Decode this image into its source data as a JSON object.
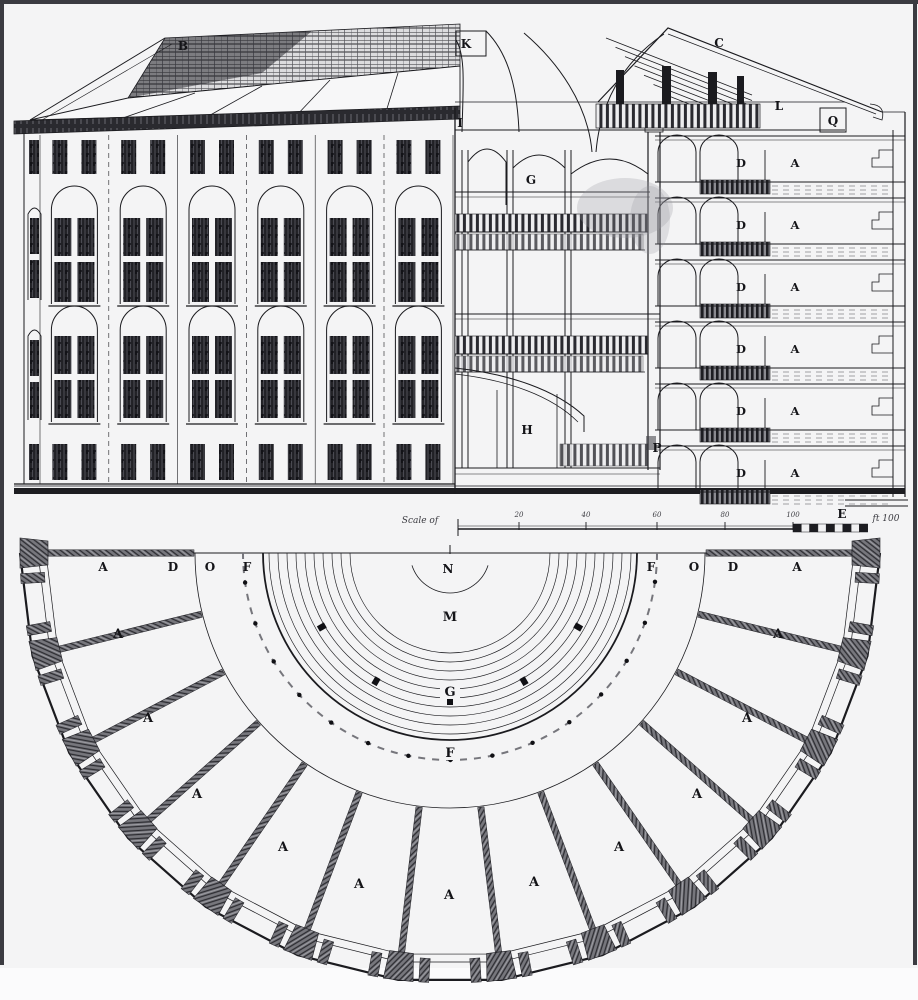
{
  "palette": {
    "paper": "#f4f4f5",
    "ink": "#1b1b1f",
    "mid_gray": "#6e6e74",
    "dark": "#1d1d21",
    "frame": "#3b3b41"
  },
  "section": {
    "labels": [
      {
        "t": "B",
        "x": 183,
        "y": 50
      },
      {
        "t": "K",
        "x": 466,
        "y": 48
      },
      {
        "t": "C",
        "x": 719,
        "y": 47
      },
      {
        "t": "I",
        "x": 460,
        "y": 127
      },
      {
        "t": "G",
        "x": 531,
        "y": 184
      },
      {
        "t": "L",
        "x": 779,
        "y": 110
      },
      {
        "t": "Q",
        "x": 833,
        "y": 125
      },
      {
        "t": "H",
        "x": 527,
        "y": 434
      },
      {
        "t": "P",
        "x": 657,
        "y": 452
      },
      {
        "t": "E",
        "x": 842,
        "y": 518
      }
    ],
    "cell_door_letter": "D",
    "cell_room_letter": "A",
    "level_tops": [
      136,
      198,
      260,
      322,
      384,
      446
    ]
  },
  "scale_bar": {
    "left_text": "Scale of",
    "tick_labels": [
      "20",
      "40",
      "60",
      "80",
      "100"
    ],
    "right_text": "ft 100"
  },
  "plan": {
    "top_row_labels": [
      {
        "t": "A",
        "x": 103,
        "y": 571
      },
      {
        "t": "D",
        "x": 173,
        "y": 571
      },
      {
        "t": "O",
        "x": 210,
        "y": 571
      },
      {
        "t": "F",
        "x": 247,
        "y": 571
      },
      {
        "t": "N",
        "x": 448,
        "y": 573
      },
      {
        "t": "F",
        "x": 651,
        "y": 571
      },
      {
        "t": "O",
        "x": 694,
        "y": 571
      },
      {
        "t": "D",
        "x": 733,
        "y": 571
      },
      {
        "t": "A",
        "x": 797,
        "y": 571
      }
    ],
    "ring_labels": [
      {
        "t": "M",
        "x": 450,
        "y": 621
      },
      {
        "t": "G",
        "x": 450,
        "y": 696
      },
      {
        "t": "F",
        "x": 450,
        "y": 757
      }
    ],
    "cell_letter": "A",
    "cell_count": 13,
    "cell_label_points": [
      [
        118,
        638
      ],
      [
        148,
        722
      ],
      [
        197,
        798
      ],
      [
        283,
        851
      ],
      [
        359,
        888
      ],
      [
        449,
        899
      ],
      [
        534,
        886
      ],
      [
        619,
        851
      ],
      [
        697,
        798
      ],
      [
        747,
        722
      ],
      [
        778,
        638
      ]
    ]
  }
}
